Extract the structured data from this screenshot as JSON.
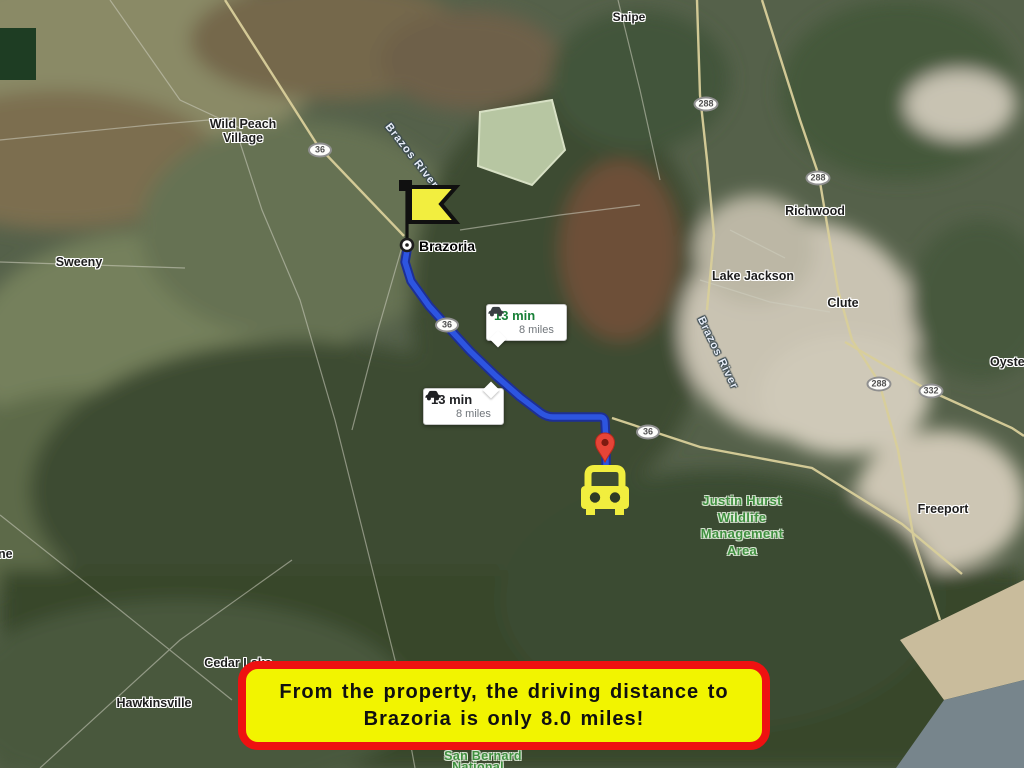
{
  "banner": {
    "line1": "From the property, the driving distance to",
    "line2": "Brazoria is only 8.0 miles!"
  },
  "route_bubble": {
    "duration": "13 min",
    "distance": "8 miles"
  },
  "towns": {
    "snipe": "Snipe",
    "wild_peach_line1": "Wild Peach",
    "wild_peach_line2": "Village",
    "sweeny": "Sweeny",
    "brazoria": "Brazoria",
    "richwood": "Richwood",
    "lake_jackson": "Lake Jackson",
    "clute": "Clute",
    "oyster": "Oyster",
    "freeport": "Freeport",
    "cedar_lake": "Cedar Lake",
    "hawkinsville": "Hawkinsville",
    "left_edge_partial": "ne"
  },
  "areas": {
    "justin_hurst_line1": "Justin Hurst",
    "justin_hurst_line2": "Wildlife",
    "justin_hurst_line3": "Management",
    "justin_hurst_line4": "Area",
    "san_bernard_line1": "San Bernard",
    "san_bernard_line2": "National"
  },
  "rivers": {
    "brazos": "Brazos River"
  },
  "shields": {
    "route_36": "36",
    "route_288": "288",
    "route_332": "332"
  },
  "colors": {
    "route_blue": "#2d55e0",
    "route_blue_outline": "#1d2f96",
    "banner_yellow": "#f2f400",
    "banner_border_red": "#ee1111",
    "flag_yellow": "#f2ee3f",
    "car_yellow": "#f1ee3e",
    "pin_red": "#e64437",
    "duration_green": "#188038",
    "area_label_green": "#3f8f3f"
  }
}
